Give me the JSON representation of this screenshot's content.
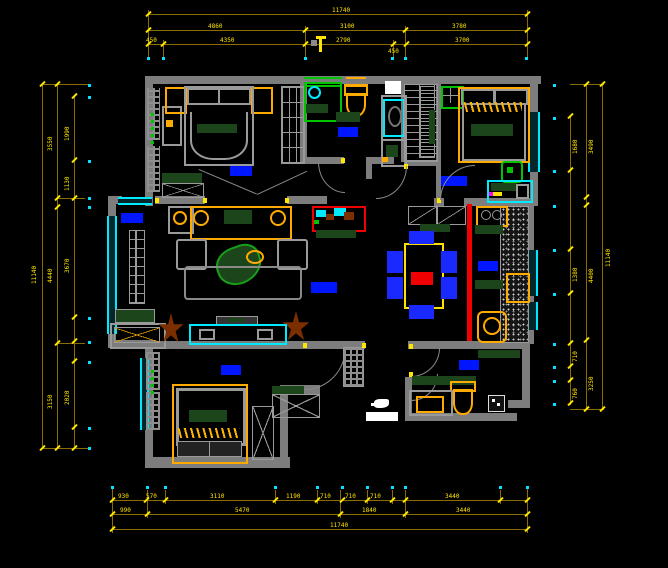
{
  "meta": {
    "title": "Residential apartment floor plan - CAD drawing",
    "canvas": {
      "width": 668,
      "height": 568
    },
    "background": "#000000"
  },
  "colors": {
    "wall_gray": "#7d7d7d",
    "dim_line": "#8a6d00",
    "dim_text": "#ffe600",
    "extension_dot": "#00e5ff",
    "window_cyan": "#00eaff",
    "accent_orange": "#ffaa00",
    "dark_green": "#1c451c",
    "bright_green": "#00c400",
    "label_blue": "#0016ff",
    "highlight_red": "#f00000",
    "plant_brown": "#7b2e00",
    "table_yellow": "#ffe000",
    "chair_blue": "#1a2aff",
    "white": "#ffffff"
  },
  "dims": {
    "top": {
      "overall": "11740",
      "mid": [
        "4860",
        "3100",
        "3780"
      ],
      "inner": [
        "450",
        "4350",
        "2790",
        "450",
        "3700"
      ]
    },
    "bottom": {
      "inner": [
        "930",
        "570",
        "3110",
        "1190",
        "710",
        "710",
        "710",
        "3440"
      ],
      "mid": [
        "990",
        "5470",
        "1840",
        "3440"
      ],
      "overall": "11740"
    },
    "left": {
      "overall": "11140",
      "mid": [
        "3550",
        "4440",
        "3150"
      ],
      "inner": [
        "1990",
        "1130",
        "3670",
        "2020"
      ]
    },
    "right": {
      "overall": "11140",
      "mid": [
        "3490",
        "4400",
        "3250"
      ],
      "inner": [
        "1680",
        "1380",
        "710",
        "760"
      ]
    }
  },
  "rooms": [
    {
      "id": "master-bedroom"
    },
    {
      "id": "bathroom"
    },
    {
      "id": "walk-in-closet"
    },
    {
      "id": "bedroom-2"
    },
    {
      "id": "balcony"
    },
    {
      "id": "living-room"
    },
    {
      "id": "dining-room"
    },
    {
      "id": "kitchen"
    },
    {
      "id": "bedroom-3"
    },
    {
      "id": "bathroom-2"
    },
    {
      "id": "entry-hall"
    }
  ],
  "furniture_icons": [
    "bed-icon",
    "wardrobe-icon",
    "nightstand-icon",
    "dresser-icon",
    "shower-icon",
    "toilet-icon",
    "sink-vanity-icon",
    "washer-icon",
    "ceiling-fan-icon",
    "desk-icon",
    "chair-icon",
    "sofa-icon",
    "armchair-icon",
    "coffee-table-plant-icon",
    "tv-icon",
    "tv-cabinet-icon",
    "plant-icon",
    "coat-rack-icon",
    "window-seat-icon",
    "shoe-cabinet-icon",
    "dining-table-icon",
    "dining-chair-icon",
    "stove-icon",
    "kitchen-sink-icon",
    "counter-icon",
    "door-swing-icon",
    "entry-door-icon",
    "north-marker-icon"
  ]
}
